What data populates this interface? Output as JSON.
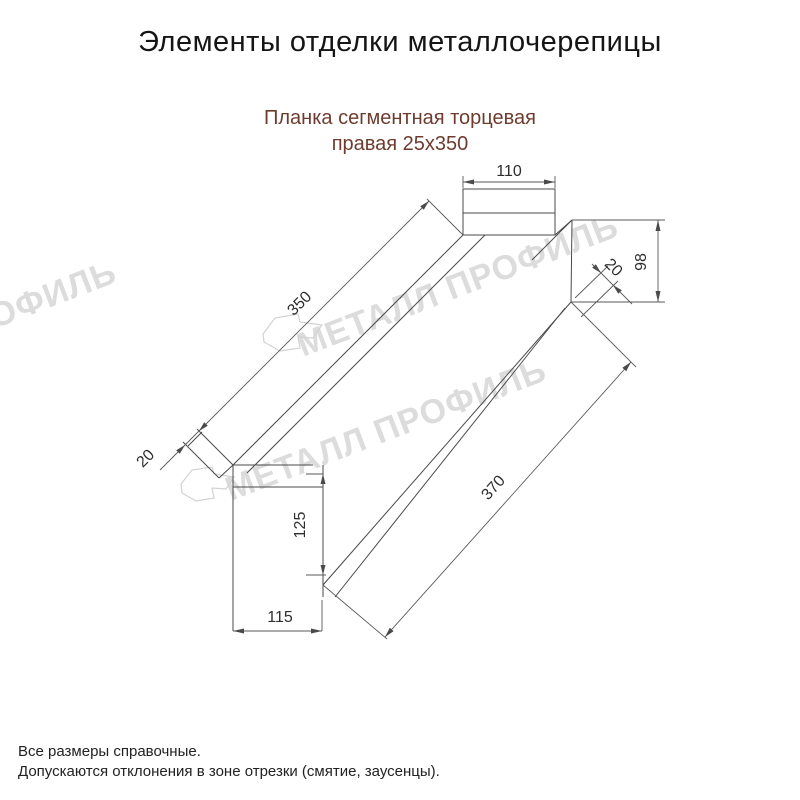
{
  "header": {
    "title": "Элементы отделки металлочерепицы",
    "subtitle_line1": "Планка сегментная торцевая",
    "subtitle_line2": "правая 25х350"
  },
  "watermark": {
    "text": "МЕТАЛЛ ПРОФИЛЬ",
    "color": "#dcdcdc"
  },
  "drawing": {
    "part_name": "Планка сегментная торцевая правая 25х350",
    "dimensions": {
      "top_tab_width": "110",
      "upper_edge_length": "350",
      "left_end_fold": "20",
      "right_end_height": "98",
      "right_edge_fold": "20",
      "bottom_tab_height": "125",
      "lower_edge_length": "370",
      "bottom_tab_width": "115"
    }
  },
  "footer": {
    "line1": "Все размеры справочные.",
    "line2": "Допускаются отклонения в зоне отрезки (смятие, заусенцы)."
  },
  "colors": {
    "line": "#4a4a4a",
    "dimension_text": "#2e2e2e",
    "title_text": "#151515",
    "subtitle_text": "#6e3c2e",
    "watermark": "#dcdcdc",
    "logo_outline": "#d2d2d2",
    "background": "#ffffff"
  }
}
